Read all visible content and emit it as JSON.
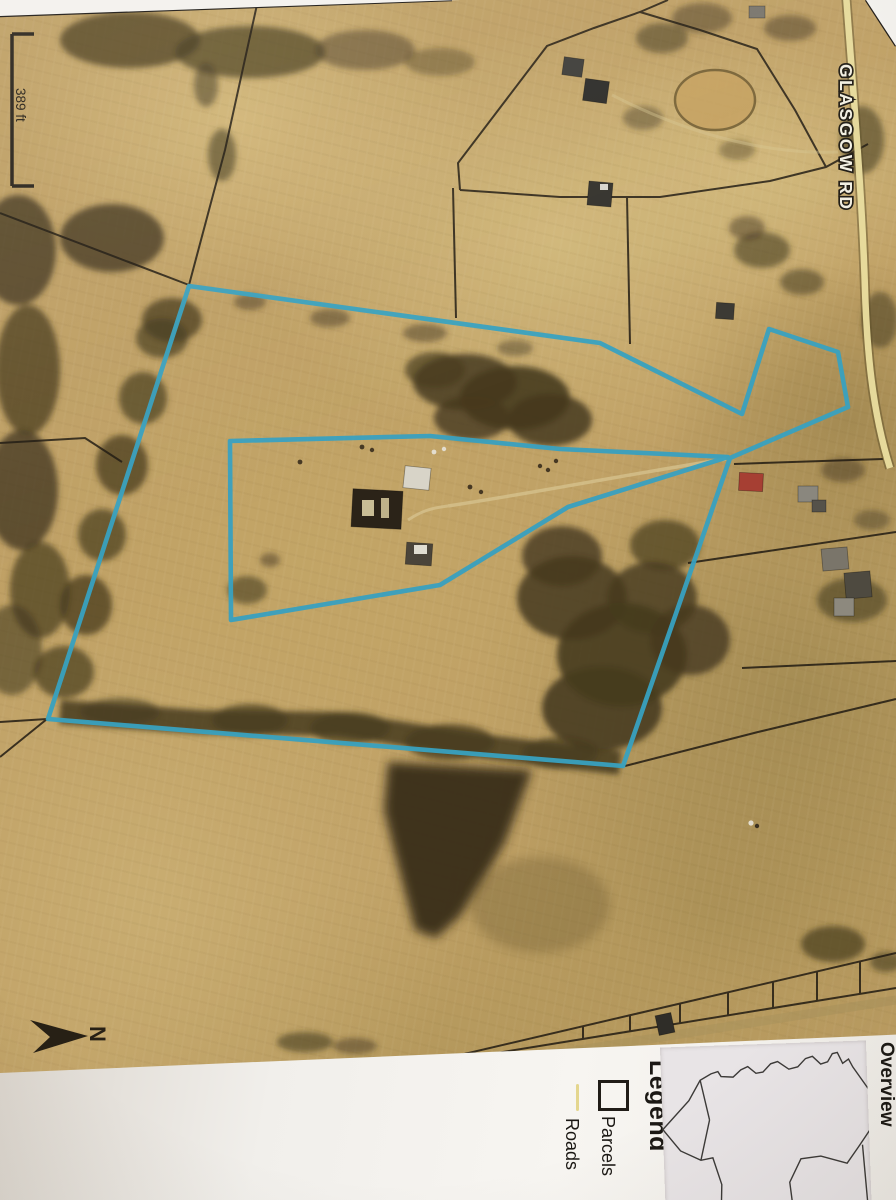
{
  "map": {
    "scale_bar_label": "389 ft",
    "road_label": "GLASGOW RD",
    "north_label": "N",
    "colors": {
      "parcel_highlight": "#38a1c0",
      "road_fill": "#ecdfa0",
      "boundary_lines": "#1f1913",
      "field_base": "#bfa065",
      "paper": "#f2f0ec"
    }
  },
  "legend": {
    "title": "Legend",
    "items": [
      {
        "symbol": "parcel-square",
        "label": "Parcels"
      },
      {
        "symbol": "road-line",
        "label": "Roads"
      }
    ],
    "inset_title": "Overview"
  }
}
